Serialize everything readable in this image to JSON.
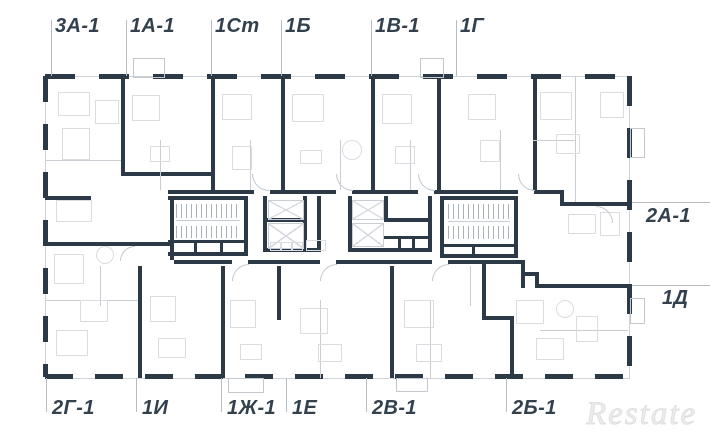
{
  "type": "apartment-floor-plan",
  "units": {
    "top": [
      "3А-1",
      "1А-1",
      "1Ст",
      "1Б",
      "1В-1",
      "1Г"
    ],
    "right": [
      "2А-1",
      "1Д"
    ],
    "bottom": [
      "2Г-1",
      "1И",
      "1Ж-1",
      "1Е",
      "2В-1",
      "2Б-1"
    ]
  },
  "watermark": "Restate",
  "colors": {
    "wall": "#2c3a47",
    "label_text": "#33414f",
    "thin_line": "#c9ced4",
    "furniture_line": "#d9dde2",
    "leader_line": "#b5bcc3",
    "watermark_text": "#ececec",
    "background": "#ffffff"
  }
}
